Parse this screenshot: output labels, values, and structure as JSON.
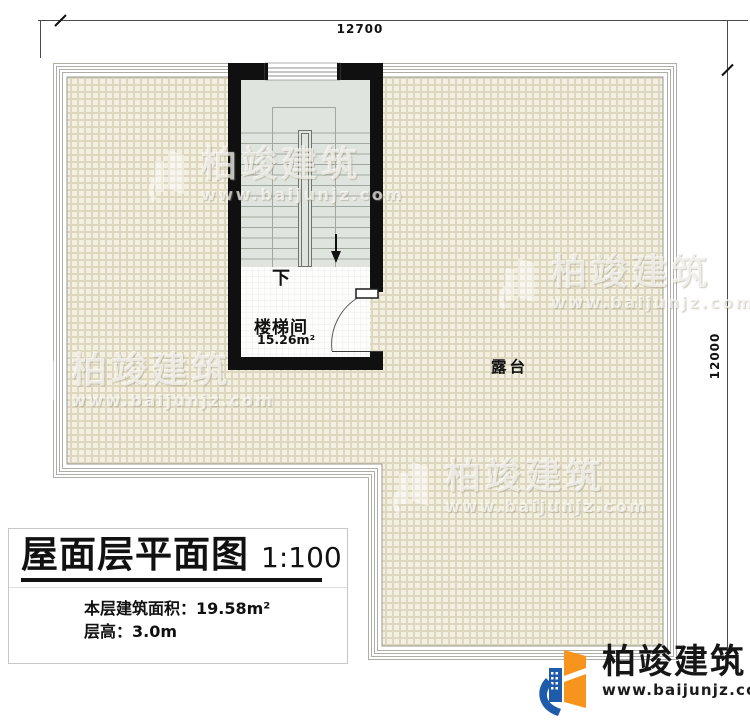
{
  "plan": {
    "dimensions": {
      "top": "12700",
      "right": "12000"
    },
    "stairwell": {
      "label": "楼梯间",
      "area": "15.26m²",
      "direction": "下"
    },
    "terrace": {
      "label": "露台"
    }
  },
  "title_block": {
    "title": "屋面层平面图",
    "scale": "1:100",
    "area_line": "本层建筑面积：19.58m²",
    "height_line": "层高：3.0m"
  },
  "branding": {
    "name": "柏竣建筑",
    "website": "www.baijunjz.com"
  },
  "icons": {
    "watermark": "building-swoosh-icon",
    "logo": "building-swoosh-icon"
  },
  "colors": {
    "wall": "#101010",
    "tile_floor": "#f3f0e2",
    "tile_line": "#dcd6bf",
    "stair_floor": "#e0e4de",
    "parapet_line": "#aeada6",
    "brand_orange": "#f7941e",
    "brand_blue": "#1e5cab"
  }
}
